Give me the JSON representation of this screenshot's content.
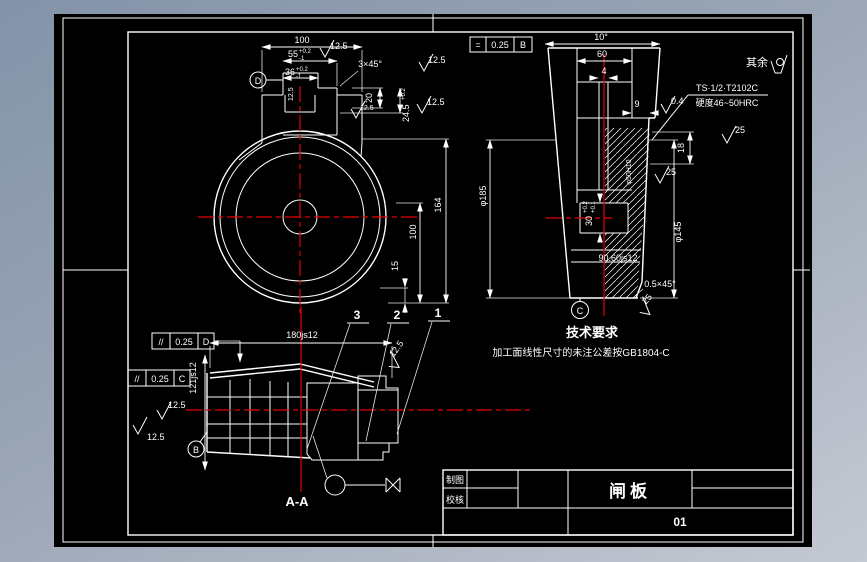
{
  "colors": {
    "canvas": "#000000",
    "line": "#ffffff",
    "centerline_red": "#e60000",
    "bg_top": "#8393a8",
    "bg_bottom": "#c5c9d3"
  },
  "front_view": {
    "datum": "D",
    "d100_top": "100",
    "d55": "55",
    "d55_up": "+0.2",
    "d55_dn": "-1",
    "d36": "36",
    "d36_up": "+0.2",
    "d36_dn": "-1",
    "chamfer": "3×45°",
    "fin1": "12.5",
    "fin2": "12.5",
    "fin3": "12.5",
    "fin4": "12.5",
    "fin5": "12.5",
    "d164": "164",
    "d100_side": "100",
    "d15": "15",
    "d20": "20",
    "d245": "24.5",
    "d245_up": "+0.2"
  },
  "side_view": {
    "fcf": {
      "symbol": "=",
      "tolerance": "0.25",
      "datum": "B"
    },
    "d_angle": "10°",
    "d60": "60",
    "d4": "4",
    "d9": "9",
    "fin04": "0.4",
    "fin25_a": "25",
    "fin25_b": "25",
    "fin25_c": "25",
    "note_line1": "TS·1/2·T2102C",
    "note_line2": "硬度46~50HRC",
    "rest_label": "其余",
    "d18": "18",
    "d145": "φ145",
    "d185": "φ185",
    "d30": "30",
    "d30_up": "+0.2",
    "d30_dn": "+0.1",
    "d50": "φ50H10",
    "d906": "90.60js12",
    "ch05": "0.5×45°",
    "datum": "C"
  },
  "section_view": {
    "label": "A-A",
    "fcf_d": {
      "symbol": "//",
      "tolerance": "0.25",
      "datum": "D"
    },
    "fcf_c": {
      "symbol": "//",
      "tolerance": "0.25",
      "datum": "C"
    },
    "d180": "180js12",
    "d121": "121js12",
    "fin1": "12.5",
    "fin2": "12.5",
    "fin3": "12.5",
    "item1": "1",
    "item2": "2",
    "item3": "3",
    "datum": "B"
  },
  "tech_req": {
    "title": "技术要求",
    "line1": "加工面线性尺寸的未注公差按GB1804-C"
  },
  "title_block": {
    "draw_label": "制图",
    "check_label": "校核",
    "part_name": "闸板",
    "drawing_no": "01"
  }
}
